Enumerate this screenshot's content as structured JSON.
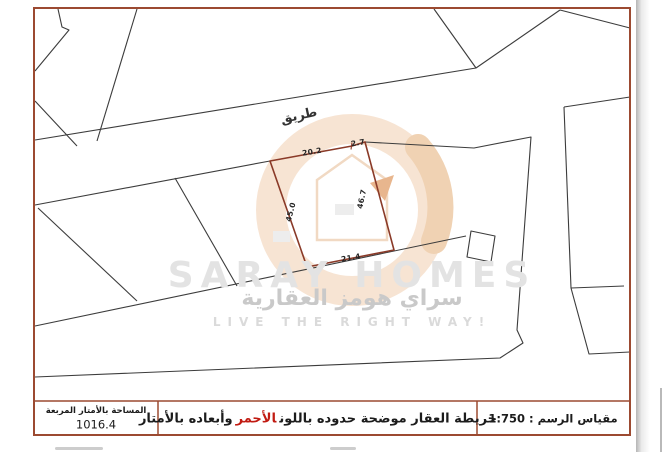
{
  "map": {
    "road_label": "طريق",
    "plot_dimensions": {
      "top": "20.2",
      "top_right": "2.7",
      "left": "45.0",
      "right": "46.7",
      "bottom": "21.4"
    },
    "colors": {
      "border": "#9c4a31",
      "parcel_lines": "#3c3c3c",
      "plot_boundary": "#8a3a28"
    }
  },
  "watermark": {
    "brand_en": "SARAY HOMES",
    "brand_ar": "سراي هومز العقارية",
    "tagline": "LIVE THE RIGHT WAY!"
  },
  "footer": {
    "area": {
      "label": "المساحة بالأمتار المربعة",
      "value": "1016.4"
    },
    "note": {
      "part1": "خريطة العقار موضحة حدوده باللون",
      "red_word": "الأحمر",
      "part2": "وأبعاده بالأمتار",
      "red_color": "#c11b12"
    },
    "scale": "مقياس الرسم : 1:750"
  }
}
